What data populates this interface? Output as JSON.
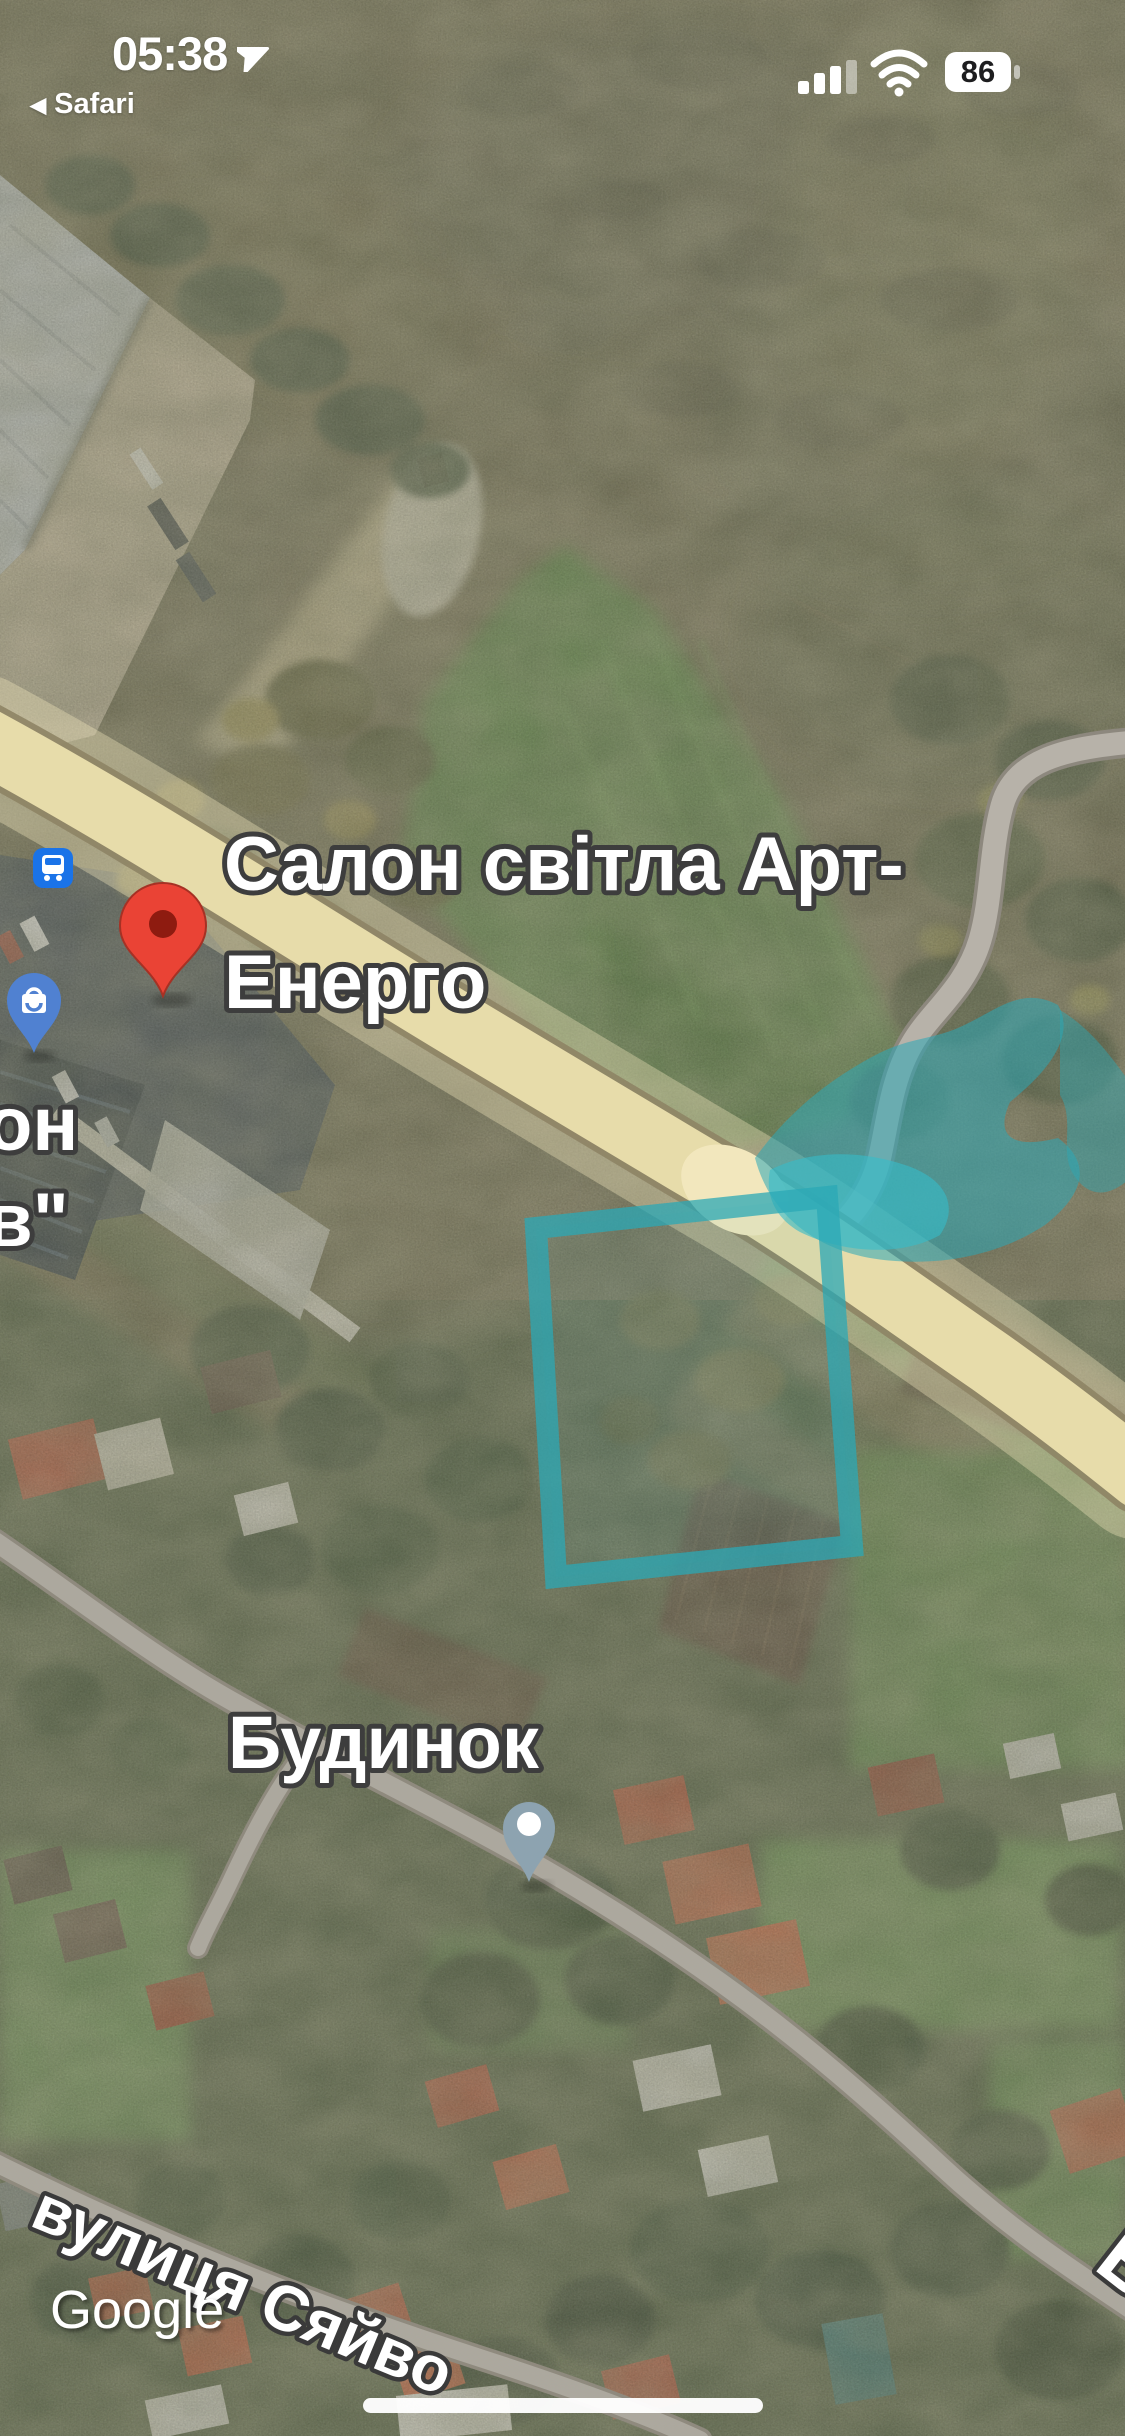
{
  "status_bar": {
    "time": "05:38",
    "back_chevron": "◀",
    "back_app": "Safari",
    "battery_percent": "86",
    "cellular_bars_active": 3,
    "cellular_bars_total": 4
  },
  "map": {
    "labels": {
      "poi_main_line1": "Салон світла Арт-",
      "poi_main_line2": "Енерго",
      "poi_partial_line1": "он",
      "poi_partial_line2": "в\"",
      "house": "Будинок",
      "street": "вулиця Сяйво",
      "street_partial": "В"
    },
    "watermark": "Google",
    "pins": [
      {
        "name": "red-place-pin",
        "type": "place"
      },
      {
        "name": "shopping-pin",
        "type": "shopping"
      },
      {
        "name": "bus-stop-icon",
        "type": "transit-stop"
      },
      {
        "name": "gray-dot-pin",
        "type": "secondary-place"
      }
    ],
    "colors": {
      "selection_teal": "#2BA8B6",
      "highway_fill": "#ECE0AE",
      "place_pin_red": "#EA4335",
      "place_pin_red_dark": "#8E1B10",
      "transit_blue": "#1A73E8",
      "shopping_pin_blue": "#5081D1",
      "secondary_pin_gray": "#8DA3B0",
      "road_gray": "#ACA89E"
    }
  }
}
